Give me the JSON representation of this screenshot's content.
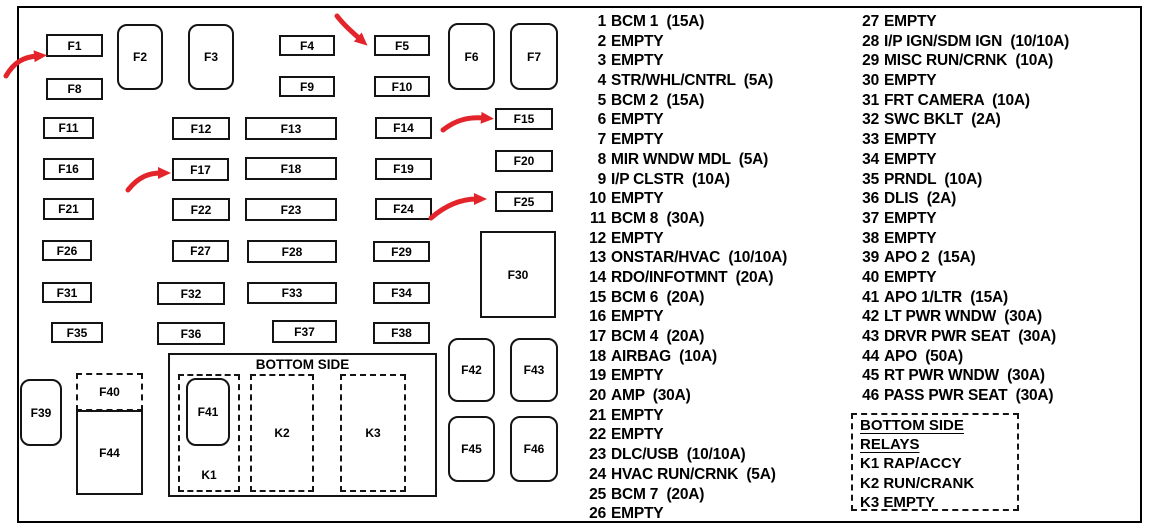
{
  "diagram": {
    "bottom_side_label": "BOTTOM SIDE",
    "fuse_ids": [
      "F1",
      "F2",
      "F3",
      "F4",
      "F5",
      "F6",
      "F7",
      "F8",
      "F9",
      "F10",
      "F11",
      "F12",
      "F13",
      "F14",
      "F15",
      "F16",
      "F17",
      "F18",
      "F19",
      "F20",
      "F21",
      "F22",
      "F23",
      "F24",
      "F25",
      "F26",
      "F27",
      "F28",
      "F29",
      "F30",
      "F31",
      "F32",
      "F33",
      "F34",
      "F35",
      "F36",
      "F37",
      "F38",
      "F39",
      "F40",
      "F41",
      "F42",
      "F43",
      "F44",
      "F45",
      "F46",
      "K1",
      "K2",
      "K3"
    ]
  },
  "arrows": {
    "color": "#e3242b",
    "targets": [
      "F1",
      "F5",
      "F15",
      "F17",
      "F25"
    ]
  },
  "legend_left": [
    {
      "n": "1",
      "t": "BCM 1  (15A)"
    },
    {
      "n": "2",
      "t": "EMPTY"
    },
    {
      "n": "3",
      "t": "EMPTY"
    },
    {
      "n": "4",
      "t": "STR/WHL/CNTRL  (5A)"
    },
    {
      "n": "5",
      "t": "BCM 2  (15A)"
    },
    {
      "n": "6",
      "t": "EMPTY"
    },
    {
      "n": "7",
      "t": "EMPTY"
    },
    {
      "n": "8",
      "t": "MIR WNDW MDL  (5A)"
    },
    {
      "n": "9",
      "t": "I/P CLSTR  (10A)"
    },
    {
      "n": "10",
      "t": "EMPTY"
    },
    {
      "n": "11",
      "t": "BCM 8  (30A)"
    },
    {
      "n": "12",
      "t": "EMPTY"
    },
    {
      "n": "13",
      "t": "ONSTAR/HVAC  (10/10A)"
    },
    {
      "n": "14",
      "t": "RDO/INFOTMNT  (20A)"
    },
    {
      "n": "15",
      "t": "BCM 6  (20A)"
    },
    {
      "n": "16",
      "t": "EMPTY"
    },
    {
      "n": "17",
      "t": "BCM 4  (20A)"
    },
    {
      "n": "18",
      "t": "AIRBAG  (10A)"
    },
    {
      "n": "19",
      "t": "EMPTY"
    },
    {
      "n": "20",
      "t": "AMP  (30A)"
    },
    {
      "n": "21",
      "t": "EMPTY"
    },
    {
      "n": "22",
      "t": "EMPTY"
    },
    {
      "n": "23",
      "t": "DLC/USB  (10/10A)"
    },
    {
      "n": "24",
      "t": "HVAC RUN/CRNK  (5A)"
    },
    {
      "n": "25",
      "t": "BCM 7  (20A)"
    },
    {
      "n": "26",
      "t": "EMPTY"
    }
  ],
  "legend_right": [
    {
      "n": "27",
      "t": "EMPTY"
    },
    {
      "n": "28",
      "t": "I/P IGN/SDM IGN  (10/10A)"
    },
    {
      "n": "29",
      "t": "MISC RUN/CRNK  (10A)"
    },
    {
      "n": "30",
      "t": "EMPTY"
    },
    {
      "n": "31",
      "t": "FRT CAMERA  (10A)"
    },
    {
      "n": "32",
      "t": "SWC BKLT  (2A)"
    },
    {
      "n": "33",
      "t": "EMPTY"
    },
    {
      "n": "34",
      "t": "EMPTY"
    },
    {
      "n": "35",
      "t": "PRNDL  (10A)"
    },
    {
      "n": "36",
      "t": "DLIS  (2A)"
    },
    {
      "n": "37",
      "t": "EMPTY"
    },
    {
      "n": "38",
      "t": "EMPTY"
    },
    {
      "n": "39",
      "t": "APO 2  (15A)"
    },
    {
      "n": "40",
      "t": "EMPTY"
    },
    {
      "n": "41",
      "t": "APO 1/LTR  (15A)"
    },
    {
      "n": "42",
      "t": "LT PWR WNDW  (30A)"
    },
    {
      "n": "43",
      "t": "DRVR PWR SEAT  (30A)"
    },
    {
      "n": "44",
      "t": "APO  (50A)"
    },
    {
      "n": "45",
      "t": "RT PWR WNDW  (30A)"
    },
    {
      "n": "46",
      "t": "PASS PWR SEAT  (30A)"
    }
  ],
  "relay_box": {
    "lines": [
      {
        "t": "BOTTOM SIDE",
        "u": true
      },
      {
        "t": "RELAYS",
        "u": true
      },
      {
        "t": "K1 RAP/ACCY",
        "u": false
      },
      {
        "t": "K2 RUN/CRANK",
        "u": false
      },
      {
        "t": "K3 EMPTY",
        "u": false
      }
    ]
  }
}
